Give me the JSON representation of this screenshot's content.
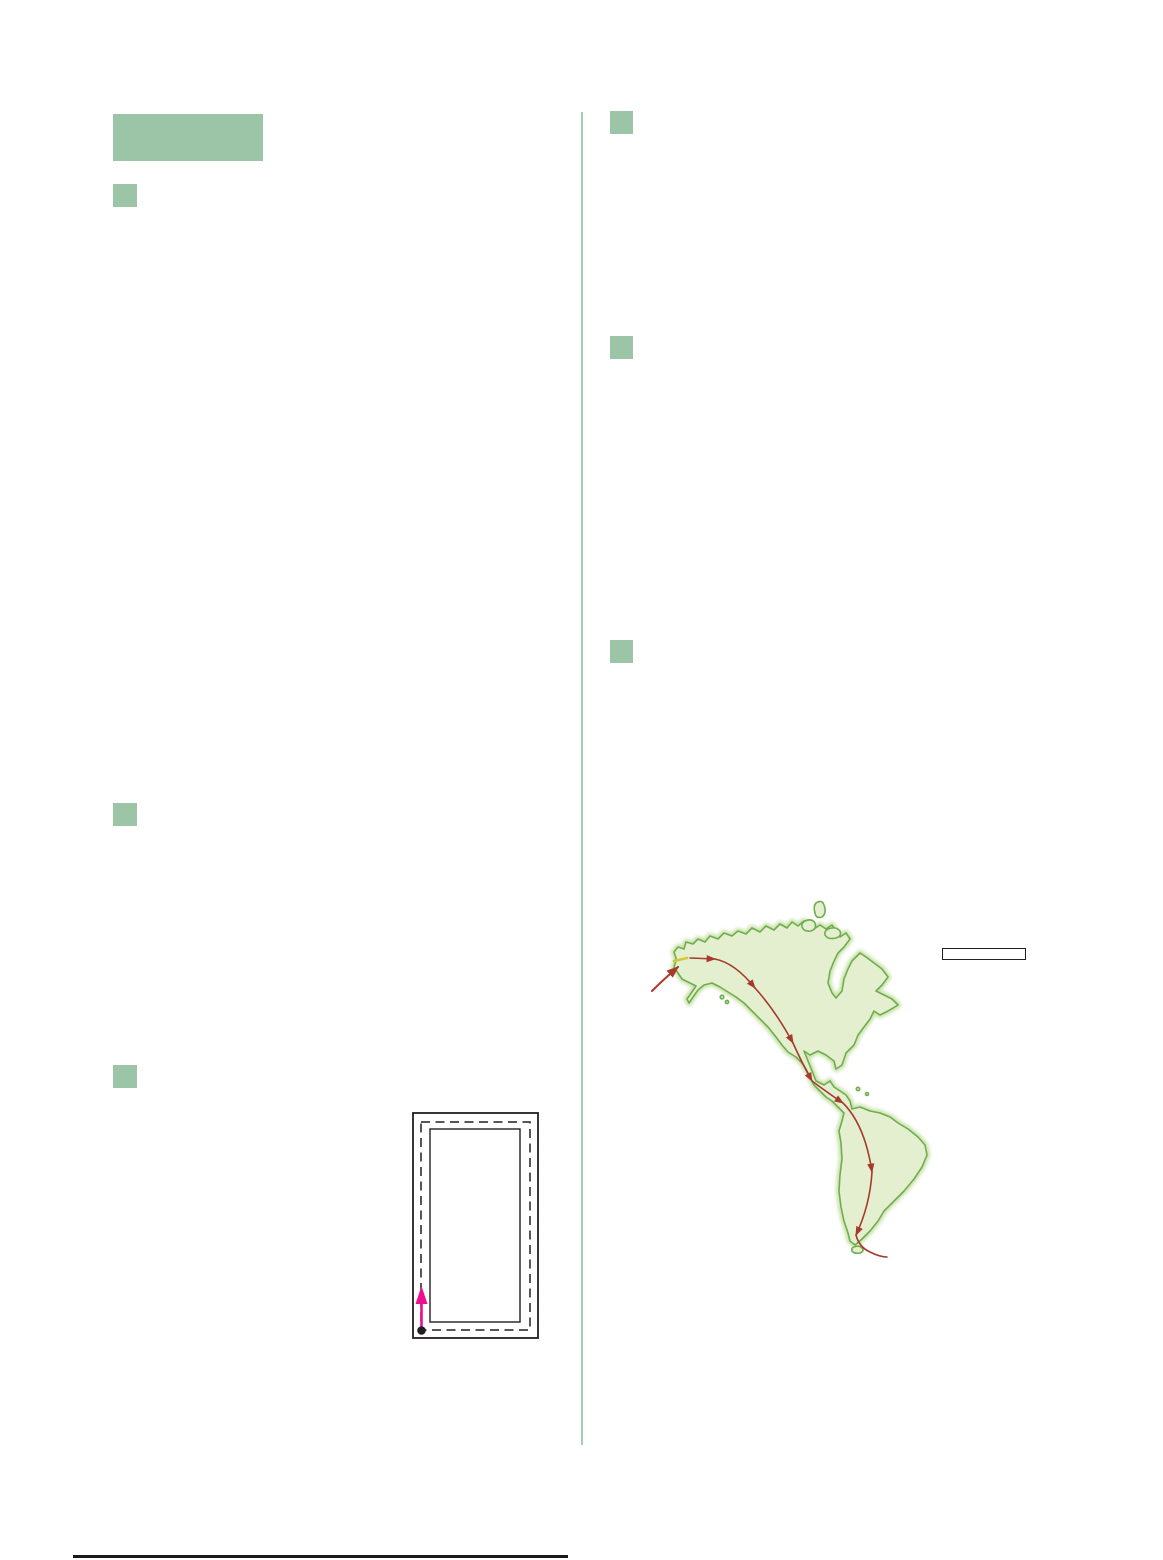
{
  "page": {
    "width": 1163,
    "height": 1560,
    "background": "#ffffff"
  },
  "palette": {
    "block_green": "#9cc4a6",
    "divider_green": "#a7cab0",
    "footer_rule": "#1a1a1a",
    "diagram_line": "#231f20",
    "diagram_arrow": "#ec0f8e",
    "map_land_fill": "#e4efd0",
    "map_land_stroke": "#6fae4e",
    "map_land_glow": "#c8e0a7",
    "map_route": "#a63a2c",
    "map_entry_arrow": "#b5392b",
    "map_bridge_yellow": "#d6c832",
    "label_box_border": "#231f20"
  },
  "left_column": {
    "header_block_text": "",
    "markers": [
      {
        "text": ""
      },
      {
        "text": ""
      },
      {
        "text": ""
      }
    ]
  },
  "right_column": {
    "markers": [
      {
        "text": ""
      },
      {
        "text": ""
      },
      {
        "text": ""
      }
    ]
  },
  "figures": {
    "margin_diagram": {
      "name": "nested-page-margins-diagram"
    },
    "americas_map": {
      "name": "americas-migration-route-map",
      "label_box_text": ""
    }
  }
}
